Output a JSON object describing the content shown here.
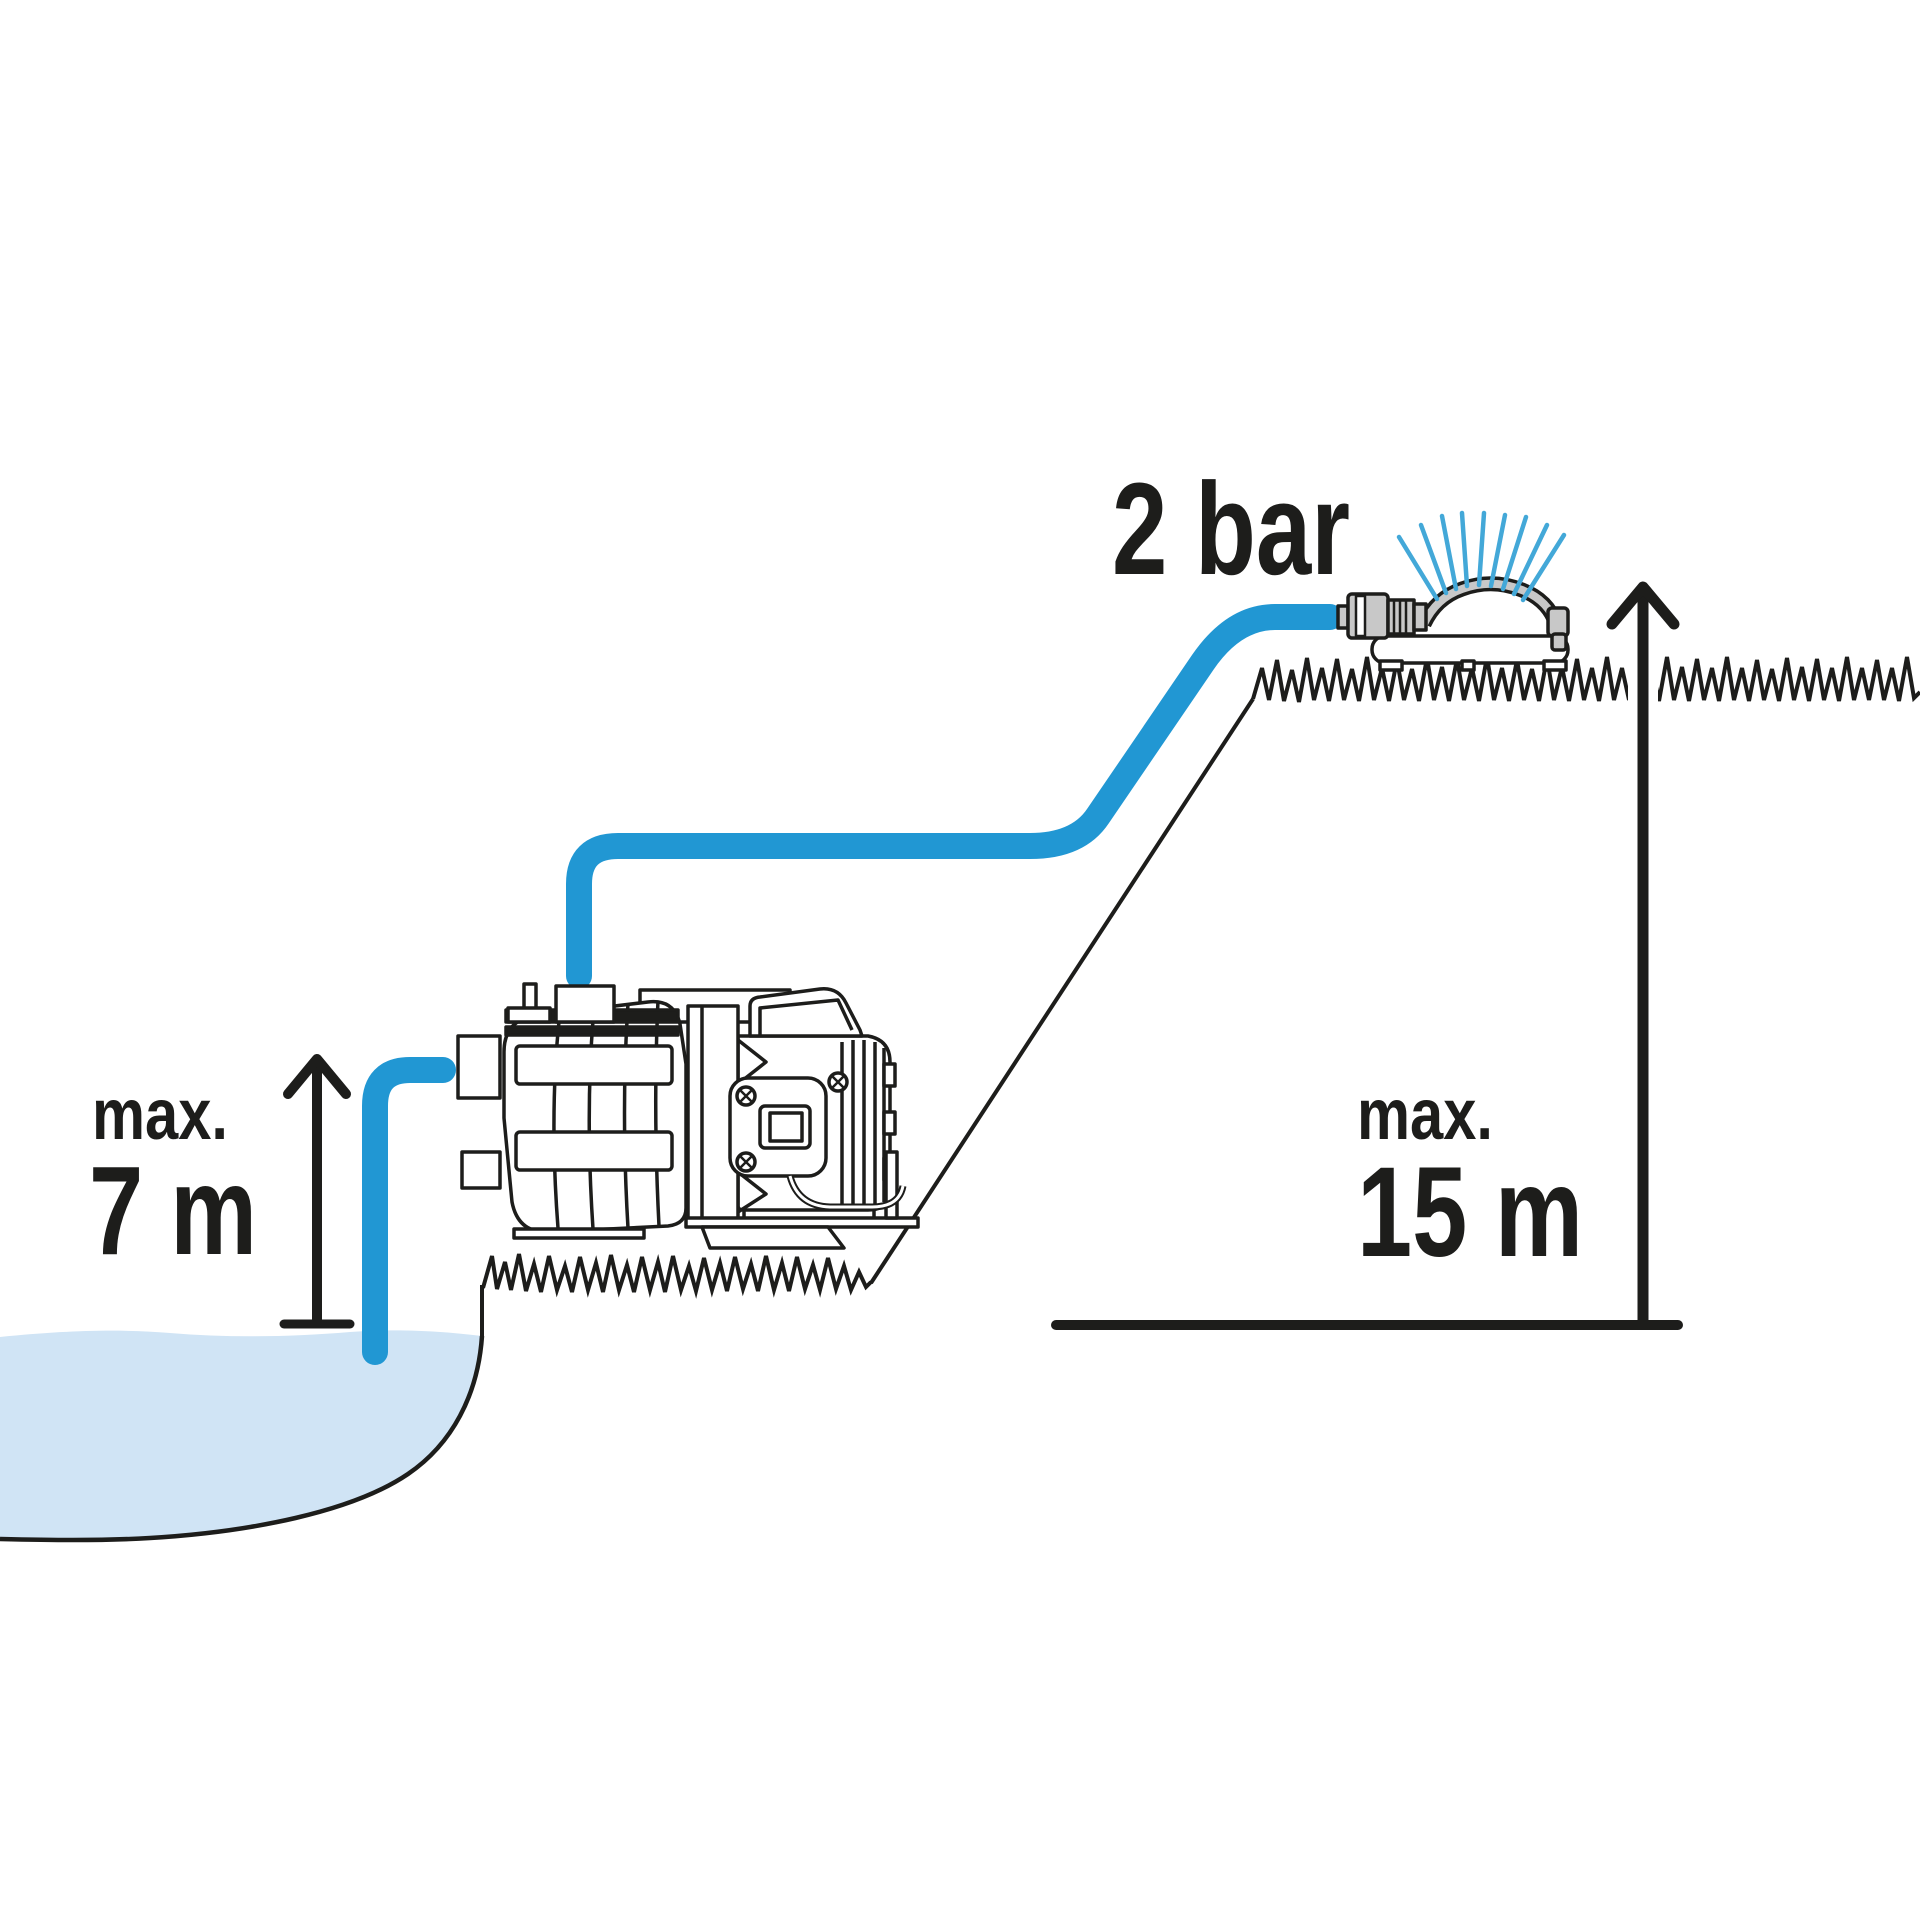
{
  "figure": {
    "type": "diagram",
    "subject": "garden-pump-suction-and-delivery-height",
    "pressure_label": "2 bar",
    "suction": {
      "prefix": "max.",
      "value": "7 m"
    },
    "delivery": {
      "prefix": "max.",
      "value": "15 m"
    },
    "colors": {
      "hose": "#2197d3",
      "spray": "#43a8d8",
      "water": "#d0e4f5",
      "metal": "#c8c8c8",
      "ink": "#1d1d1b"
    }
  }
}
